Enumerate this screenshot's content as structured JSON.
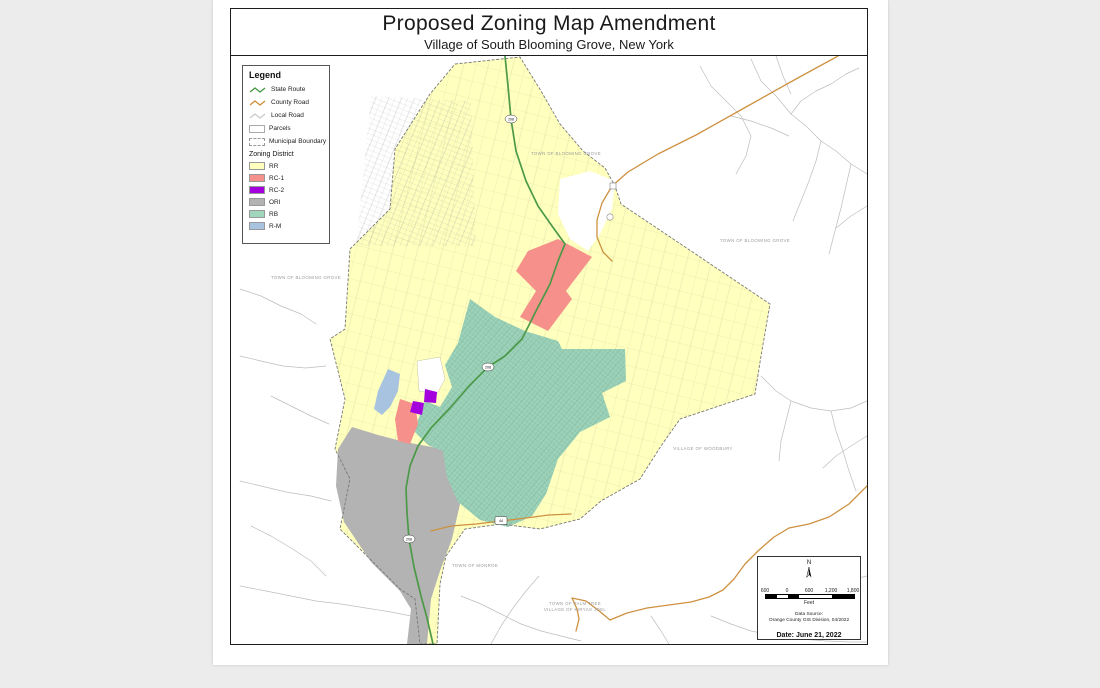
{
  "title": {
    "main": "Proposed Zoning Map Amendment",
    "subtitle": "Village of South Blooming Grove, New York"
  },
  "legend": {
    "title": "Legend",
    "lines": [
      {
        "label": "State Route",
        "color": "#4C9948"
      },
      {
        "label": "County Road",
        "color": "#CE9140"
      },
      {
        "label": "Local Road",
        "color": "#CCCCCC"
      }
    ],
    "boxes": [
      {
        "label": "Parcels"
      },
      {
        "label": "Municipal Boundary"
      }
    ],
    "district_title": "Zoning District",
    "districts": [
      {
        "label": "RR",
        "color": "#FFFFBE"
      },
      {
        "label": "RC-1",
        "color": "#F5918A"
      },
      {
        "label": "RC-2",
        "color": "#A400DE"
      },
      {
        "label": "ORI",
        "color": "#B3B3B3"
      },
      {
        "label": "RB",
        "color": "#9FD6BC"
      },
      {
        "label": "R-M",
        "color": "#A7C3E0"
      }
    ]
  },
  "map_labels": {
    "blooming_grove": "TOWN OF BLOOMING GROVE",
    "woodbury": "VILLAGE OF WOODBURY",
    "monroe": "TOWN OF MONROE",
    "palm_tree": "TOWN OF PALM TREE",
    "kiryas_joel": "VILLAGE OF KIRYAS JOEL"
  },
  "shields": {
    "state_route": "208",
    "county_route": "44"
  },
  "scale_panel": {
    "north_label": "N",
    "ticks": [
      "600",
      "0",
      "600",
      "1,200",
      "1,800"
    ],
    "unit": "Feet",
    "source_line1": "Data Source:",
    "source_line2": "Orange County GIS Division, 04/2022",
    "date": "Date: June 21, 2022"
  }
}
